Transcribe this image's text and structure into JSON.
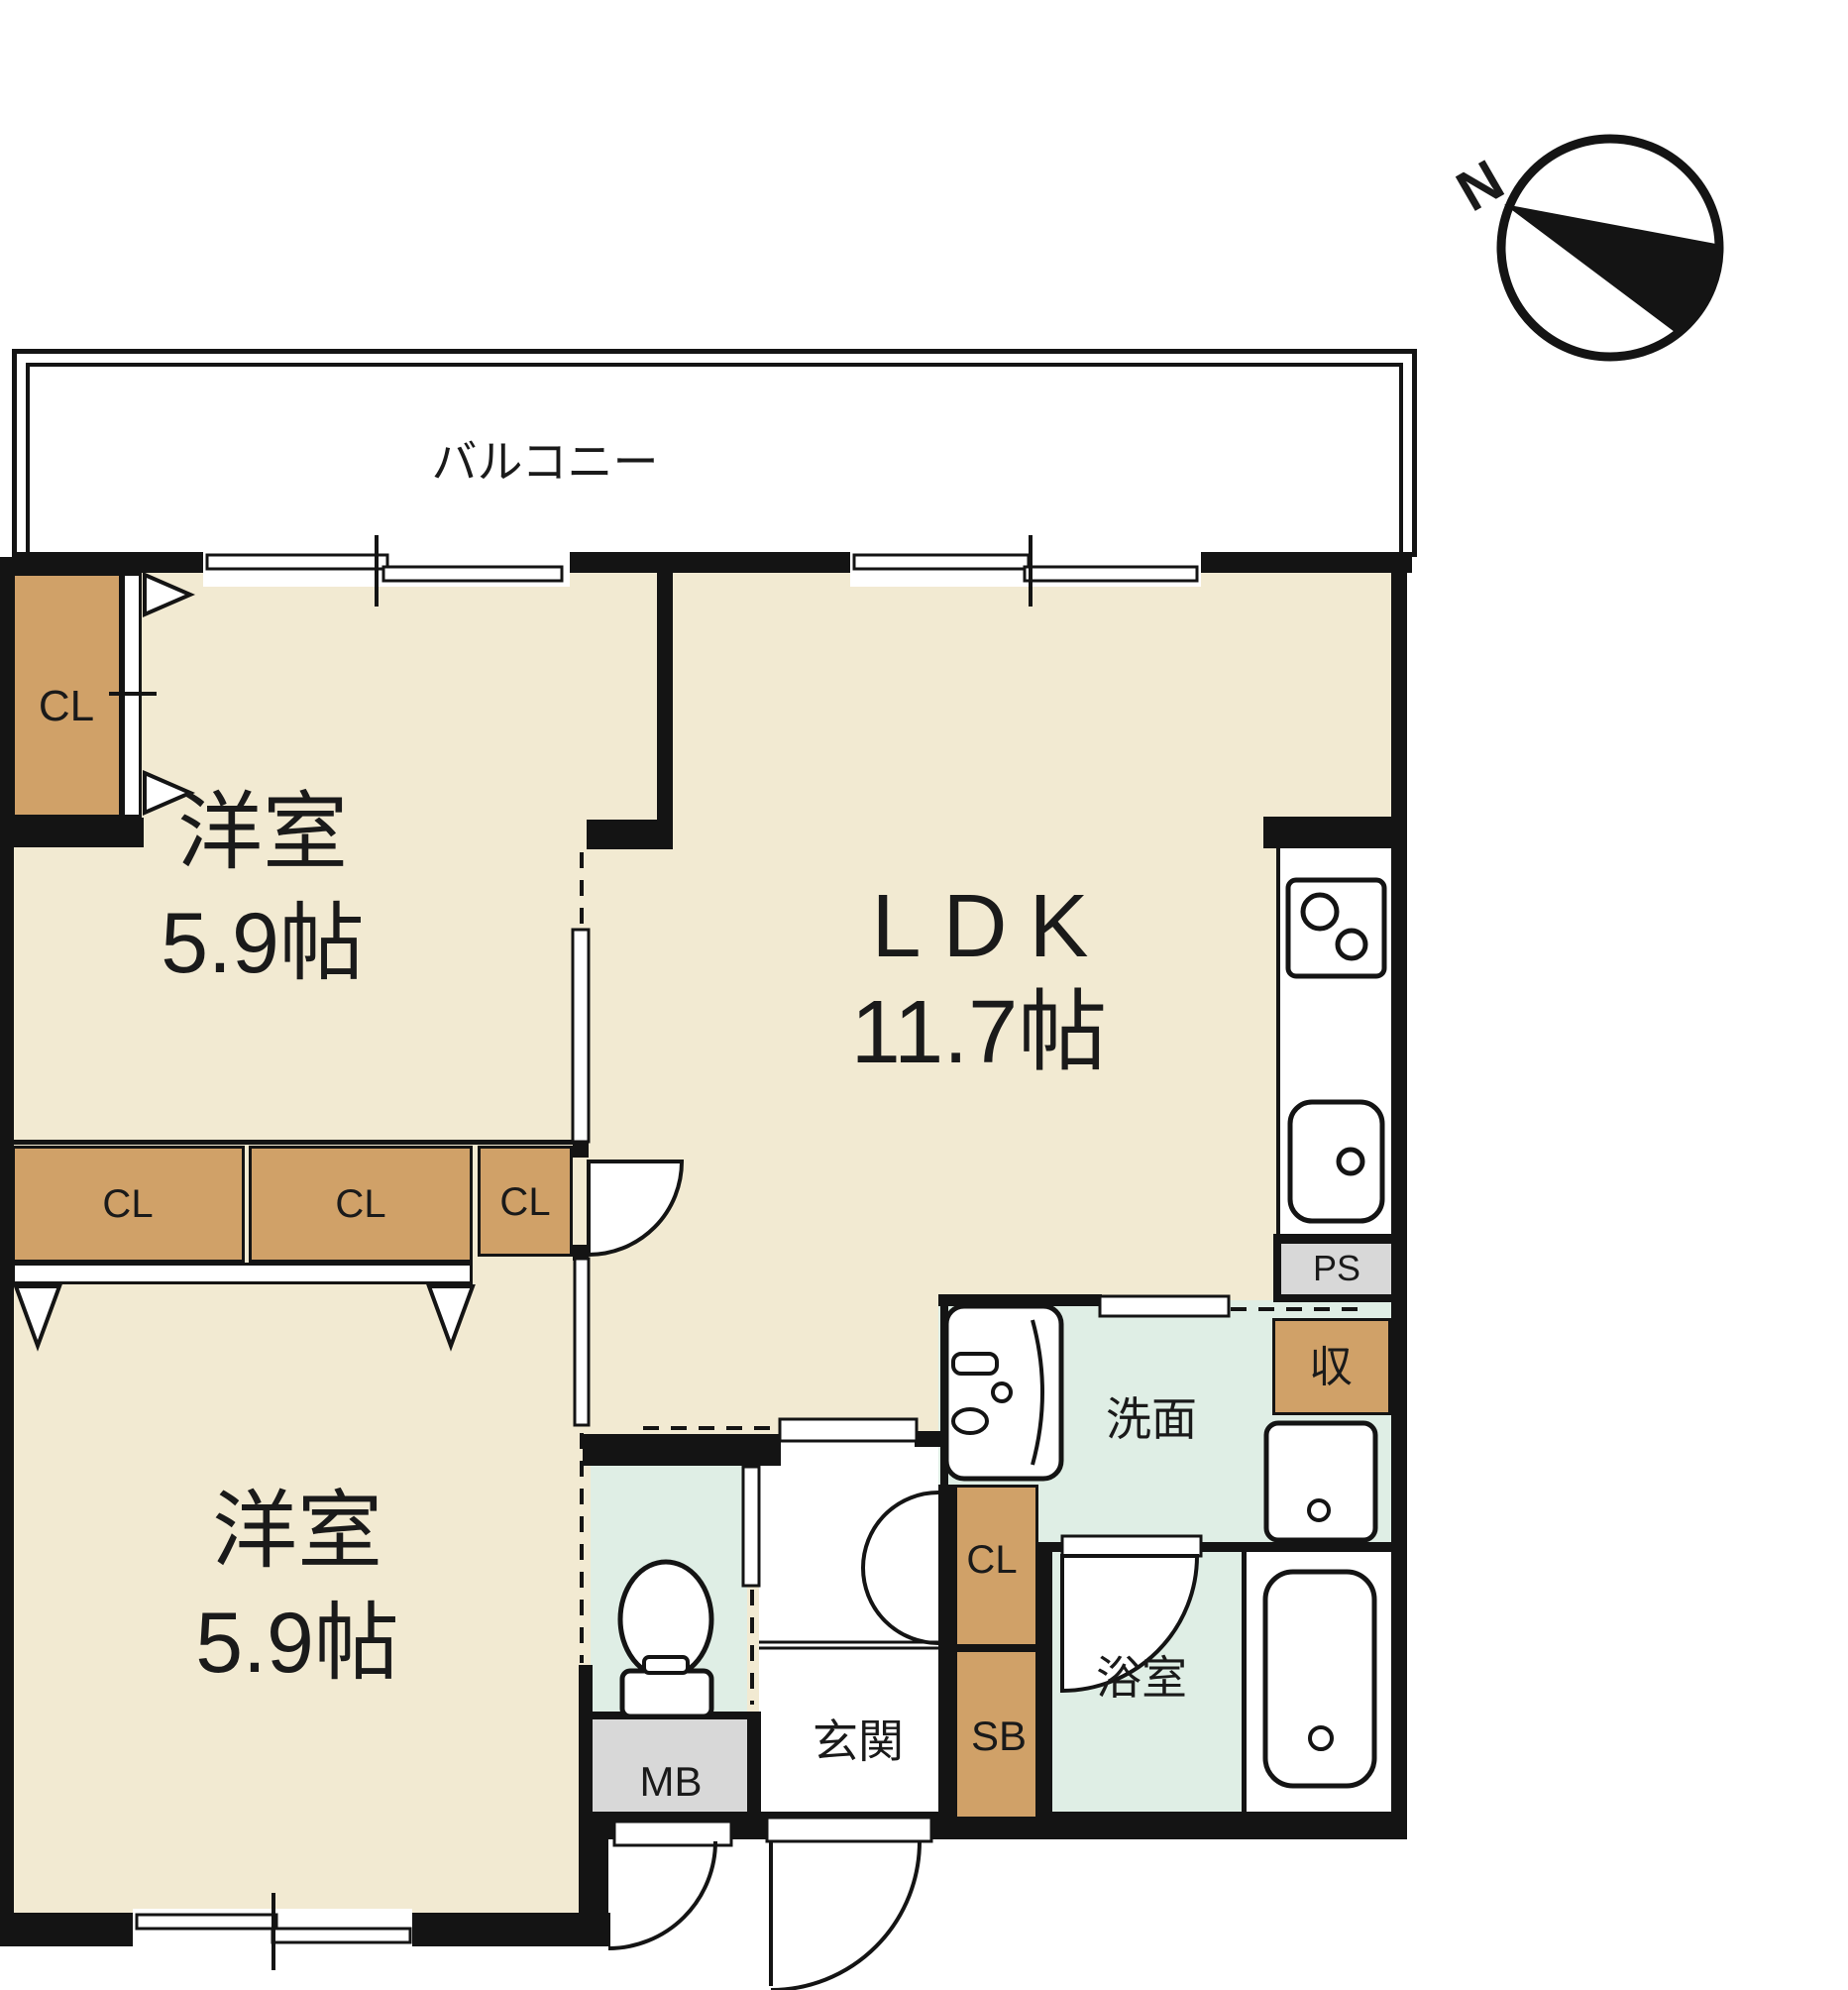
{
  "compass": {
    "north_label": "N"
  },
  "balcony": {
    "label": "バルコニー"
  },
  "rooms": {
    "western_room_top": {
      "name": "洋室",
      "size": "5.9帖"
    },
    "ldk": {
      "name": "LDK",
      "size": "11.7帖"
    },
    "western_room_bottom": {
      "name": "洋室",
      "size": "5.9帖"
    },
    "washroom": {
      "name": "洗面"
    },
    "bathroom": {
      "name": "浴室"
    },
    "entrance": {
      "name": "玄関"
    }
  },
  "fixtures": {
    "closet": "CL",
    "storage": "収",
    "shoe_box": "SB",
    "meter_box": "MB",
    "pipe_space": "PS"
  },
  "colors": {
    "wall": "#141414",
    "floor": "#F2EAD2",
    "closet": "#D0A168",
    "wet_area": "#DFEEE5",
    "utility": "#D8D8D8"
  }
}
